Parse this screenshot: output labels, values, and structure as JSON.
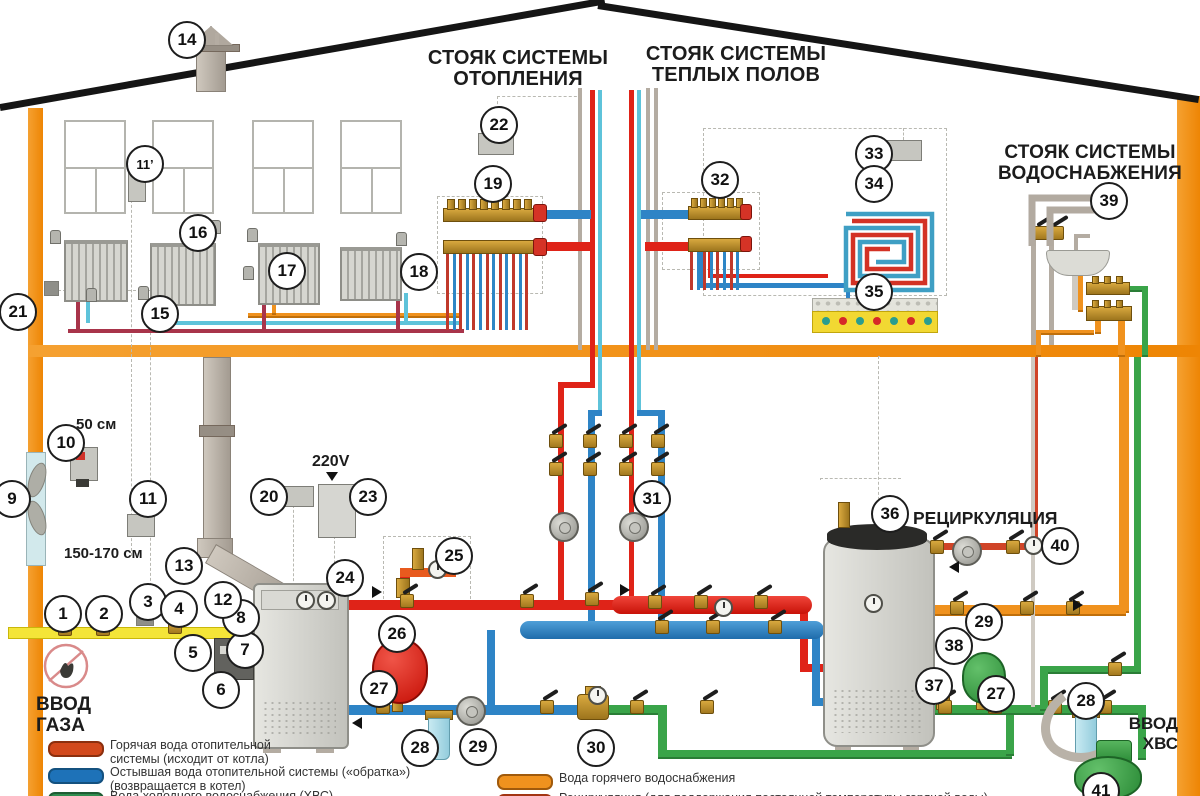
{
  "titles": {
    "heating": [
      "СТОЯК СИСТЕМЫ",
      "ОТОПЛЕНИЯ"
    ],
    "warm_floors": [
      "СТОЯК СИСТЕМЫ",
      "ТЕПЛЫХ ПОЛОВ"
    ],
    "water_supply": [
      "СТОЯК СИСТЕМЫ",
      "ВОДОСНАБЖЕНИЯ"
    ]
  },
  "labels": {
    "recirculation": "РЕЦИРКУЛЯЦИЯ",
    "gas_inlet": [
      "ВВОД",
      "ГАЗА"
    ],
    "cold_water_inlet": [
      "ВВОД",
      "ХВС"
    ],
    "voltage": "220V",
    "co_detector_height": "50 см",
    "gas_detector_height": "150-170 см"
  },
  "callouts": [
    {
      "n": "1",
      "x": 61,
      "y": 612
    },
    {
      "n": "2",
      "x": 102,
      "y": 612
    },
    {
      "n": "3",
      "x": 146,
      "y": 600
    },
    {
      "n": "4",
      "x": 177,
      "y": 607
    },
    {
      "n": "5",
      "x": 191,
      "y": 651
    },
    {
      "n": "6",
      "x": 219,
      "y": 688
    },
    {
      "n": "7",
      "x": 243,
      "y": 648
    },
    {
      "n": "8",
      "x": 239,
      "y": 616
    },
    {
      "n": "9",
      "x": 10,
      "y": 497
    },
    {
      "n": "10",
      "x": 64,
      "y": 441
    },
    {
      "n": "11",
      "x": 146,
      "y": 497
    },
    {
      "n": "11’",
      "x": 143,
      "y": 162
    },
    {
      "n": "12",
      "x": 221,
      "y": 598
    },
    {
      "n": "13",
      "x": 182,
      "y": 564
    },
    {
      "n": "14",
      "x": 185,
      "y": 38
    },
    {
      "n": "15",
      "x": 158,
      "y": 312
    },
    {
      "n": "16",
      "x": 196,
      "y": 231
    },
    {
      "n": "17",
      "x": 285,
      "y": 269
    },
    {
      "n": "18",
      "x": 417,
      "y": 270
    },
    {
      "n": "19",
      "x": 491,
      "y": 182
    },
    {
      "n": "20",
      "x": 267,
      "y": 495
    },
    {
      "n": "21",
      "x": 16,
      "y": 310
    },
    {
      "n": "22",
      "x": 497,
      "y": 123
    },
    {
      "n": "23",
      "x": 366,
      "y": 495
    },
    {
      "n": "24",
      "x": 343,
      "y": 576
    },
    {
      "n": "25",
      "x": 452,
      "y": 554
    },
    {
      "n": "26",
      "x": 395,
      "y": 632
    },
    {
      "n": "27",
      "x": 377,
      "y": 687
    },
    {
      "n": "28",
      "x": 418,
      "y": 746
    },
    {
      "n": "29",
      "x": 476,
      "y": 745
    },
    {
      "n": "30",
      "x": 594,
      "y": 746
    },
    {
      "n": "31",
      "x": 650,
      "y": 497
    },
    {
      "n": "32",
      "x": 718,
      "y": 178
    },
    {
      "n": "33",
      "x": 872,
      "y": 152
    },
    {
      "n": "34",
      "x": 872,
      "y": 182
    },
    {
      "n": "35",
      "x": 872,
      "y": 290
    },
    {
      "n": "36",
      "x": 888,
      "y": 512
    },
    {
      "n": "37",
      "x": 932,
      "y": 684
    },
    {
      "n": "38",
      "x": 952,
      "y": 644
    },
    {
      "n": "39",
      "x": 1107,
      "y": 199
    },
    {
      "n": "40",
      "x": 1058,
      "y": 544
    },
    {
      "n": "27",
      "x": 994,
      "y": 692
    },
    {
      "n": "28",
      "x": 1084,
      "y": 699
    },
    {
      "n": "29",
      "x": 982,
      "y": 620
    },
    {
      "n": "41",
      "x": 1099,
      "y": 789
    }
  ],
  "legend": {
    "left": [
      {
        "swatch": "#d2491c",
        "border": "#8b2f0e",
        "dashed": false,
        "lines": [
          "Горячая вода отопительной",
          "системы (исходит от котла)"
        ]
      },
      {
        "swatch": "#1e72b8",
        "border": "#14517f",
        "dashed": false,
        "lines": [
          "Остывшая вода отопительной системы («обратка»)",
          "(возвращается в котел)"
        ]
      },
      {
        "swatch": "#2f8c4f",
        "border": "#1e5c33",
        "dashed": false,
        "lines": [
          "Вода холодного водоснабжения (ХВС)"
        ]
      }
    ],
    "right": [
      {
        "swatch": "#f0921e",
        "border": "#a05a0c",
        "dashed": false,
        "lines": [
          "Вода горячего водоснабжения"
        ]
      },
      {
        "swatch": "#f0921e",
        "border": "#a33412",
        "dashed": true,
        "lines": [
          "Рециркуляция (для поддержания постоянной температуры горячей воды)"
        ]
      }
    ]
  },
  "colors": {
    "wall_orange": "#ee8504",
    "supply_red": "#df2318",
    "return_blue": "#2e84c6",
    "warm_floor_cyan": "#5ec3da",
    "cold_water_green": "#3aa449",
    "hot_water_orange": "#f0921e",
    "gas_yellow": "#f4e538",
    "flue_gray": "#b4aca2"
  }
}
